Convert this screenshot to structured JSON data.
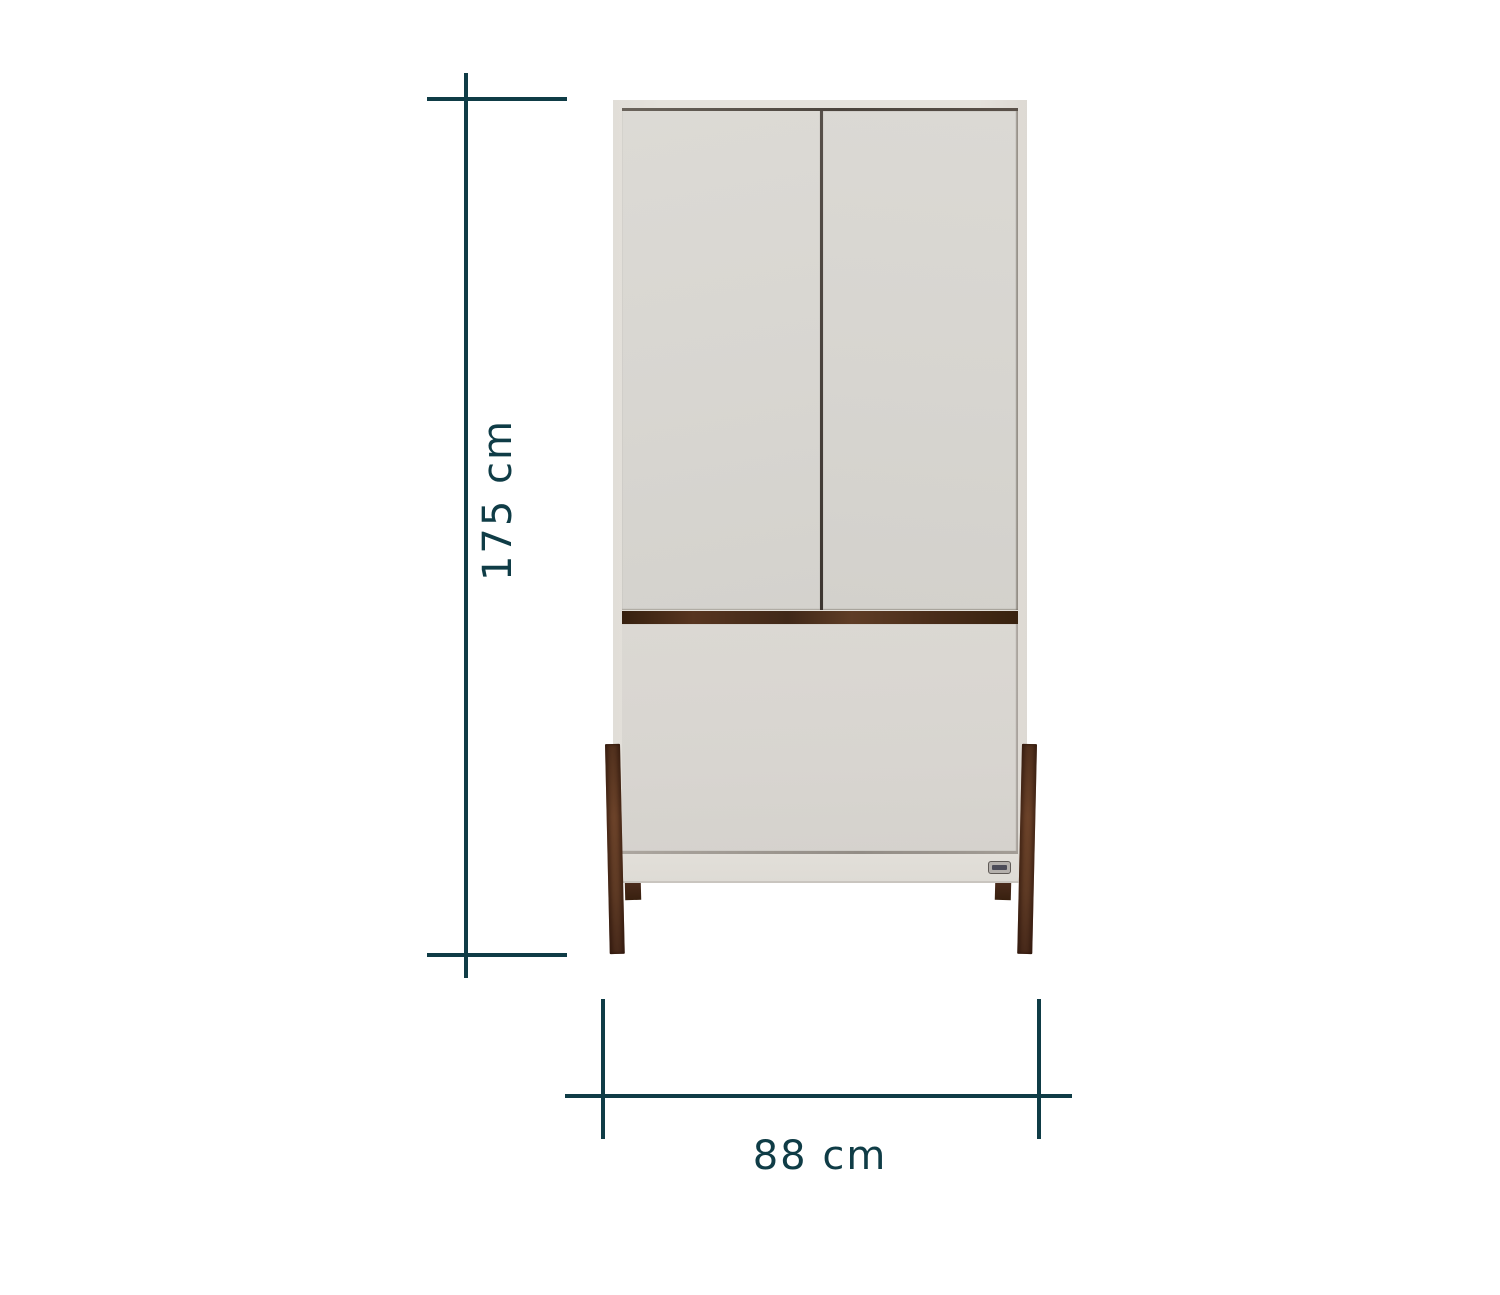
{
  "diagram": {
    "type": "furniture-dimension-diagram",
    "subject": "two-door wardrobe with drawer on angled wooden legs"
  },
  "dimensions": {
    "height_label": "175 cm",
    "width_label": "88 cm"
  },
  "colors": {
    "dim-line": "#0f3c46",
    "cabinet-face": "#d8d5d0",
    "cabinet-frame": "#e4e1db",
    "walnut-wood": "#4e3020",
    "background": "#ffffff"
  }
}
